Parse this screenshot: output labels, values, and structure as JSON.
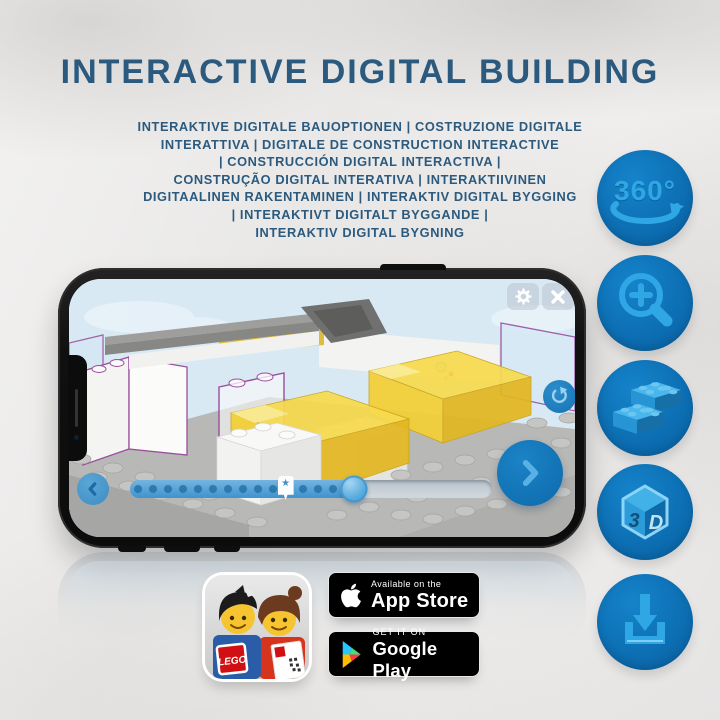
{
  "header": {
    "title": "INTERACTIVE DIGITAL BUILDING",
    "subtitle": "INTERAKTIVE DIGITALE BAUOPTIONEN | COSTRUZIONE DIGITALE\nINTERATTIVA | DIGITALE DE CONSTRUCTION INTERACTIVE\n| CONSTRUCCIÓN DIGITAL INTERACTIVA |\nCONSTRUÇÃO DIGITAL INTERATIVA | INTERAKTIIVINEN\nDIGITAALINEN RAKENTAMINEN | INTERAKTIV DIGITAL BYGGING\n| INTERAKTIVT DIGITALT BYGGANDE |\nINTERAKTIV DIGITAL BYGNING",
    "text_color": "#2b5a7e"
  },
  "feature_icons": {
    "rotation_label": "360°",
    "cube_3": "3",
    "cube_d": "D",
    "circle_color": "#0c6cb0",
    "glyph_color": "#2ea7e4",
    "items": [
      "360-rotation",
      "zoom-in",
      "brick-building",
      "3d-view",
      "download"
    ]
  },
  "phone_app": {
    "progress_percent": 62,
    "bookmark_percent": 43,
    "bookmark_star": "★",
    "screen_background": "#d9e9f4",
    "brick_yellow": "#f3cf35",
    "outline_purple": "#9a4d9d",
    "control_blue": "#0d6aab"
  },
  "badges": {
    "app_store": {
      "tagline": "Available on the",
      "name": "App Store"
    },
    "google_play": {
      "tagline": "GET IT ON",
      "name": "Google Play"
    },
    "lego_logo": "LEGO"
  }
}
